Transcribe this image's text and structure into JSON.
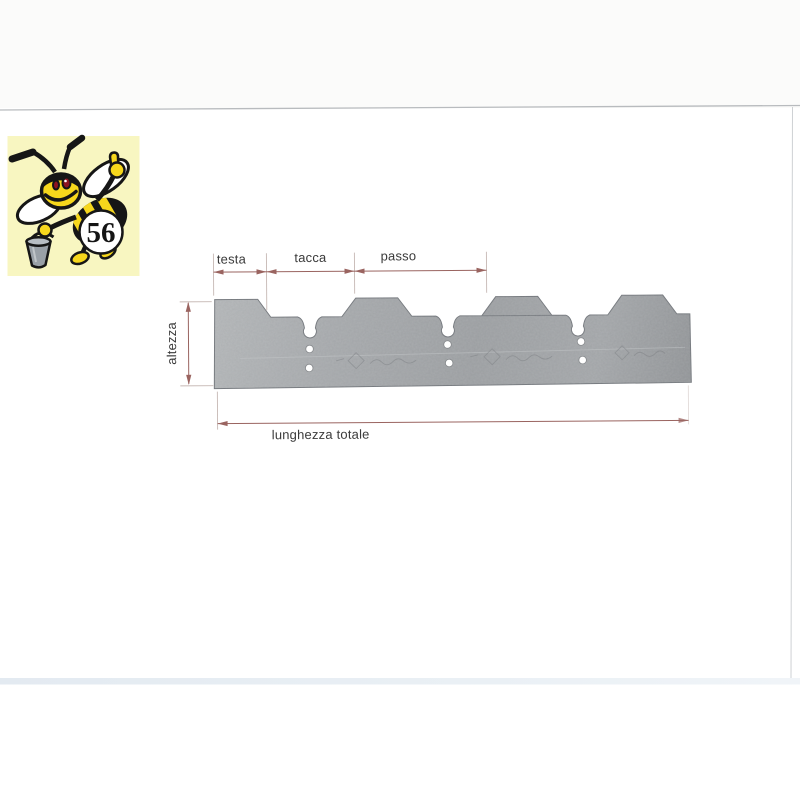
{
  "scan": {
    "background": "#ffffff",
    "paper_top_strip": "#fbfbfa",
    "page_edge_line": "#b8bbbe",
    "bottom_band": "#e6ecf2"
  },
  "logo": {
    "badge_number": "56",
    "bg_color": "#f8f6c1",
    "bee_yellow": "#f6d71c",
    "outline_black": "#161616",
    "bucket_gray": "#99a0a7"
  },
  "diagram": {
    "labels": {
      "testa": "testa",
      "tacca": "tacca",
      "passo": "passo",
      "altezza": "altezza",
      "lunghezza_totale": "lunghezza totale"
    },
    "colors": {
      "blade_fill": "#a4a7aa",
      "blade_edge": "#73777c",
      "dimension_line": "#9a6460",
      "extension_line": "#c6b8b4",
      "label_text": "#3a3a3a"
    }
  }
}
